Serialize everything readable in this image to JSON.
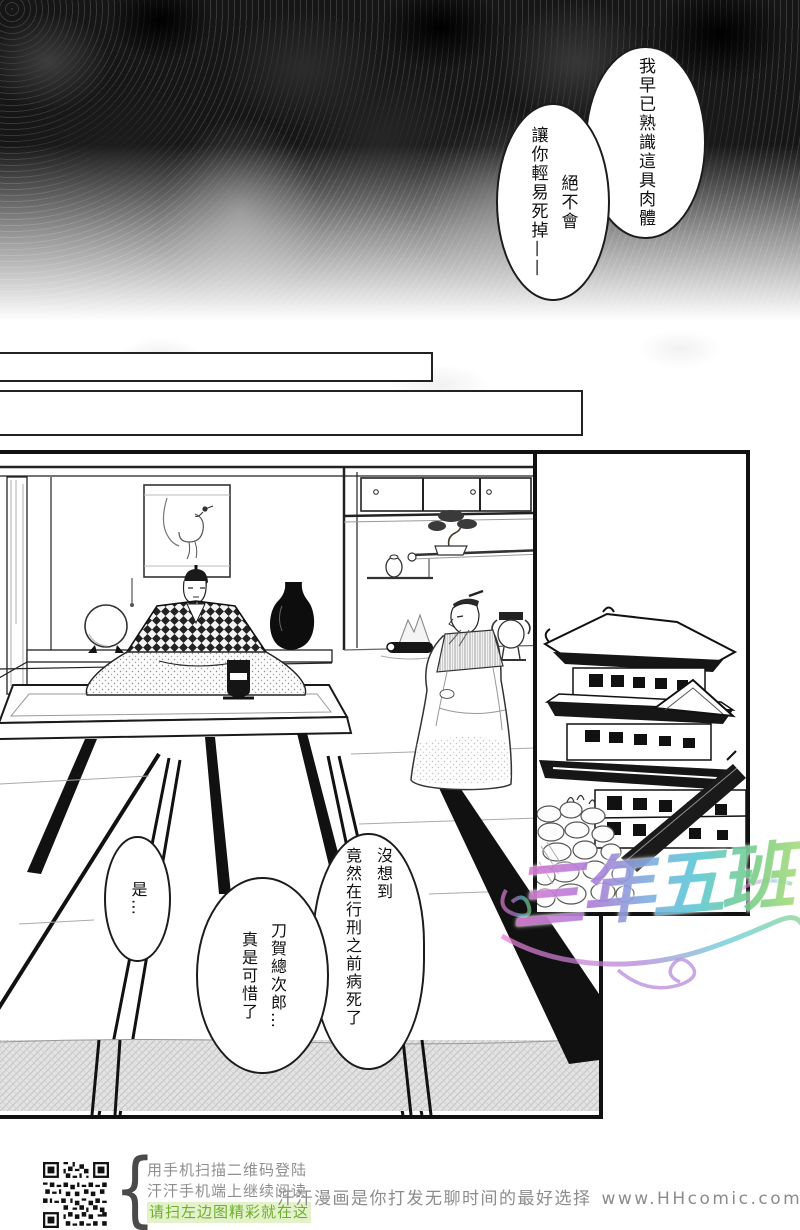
{
  "bubbles": {
    "known_body": {
      "lines": [
        "我早已熟識這具肉體"
      ]
    },
    "not_die": {
      "lines": [
        "絕不會",
        "讓你輕易死掉——"
      ]
    },
    "unexpected": {
      "lines": [
        "沒想到",
        "竟然在行刑之前病死了"
      ]
    },
    "pity": {
      "lines": [
        "刀賀總次郎…",
        "真是可惜了"
      ]
    },
    "yes": {
      "lines": [
        "是…"
      ]
    }
  },
  "watermark": {
    "text": "三年五班"
  },
  "footer": {
    "brace": "{",
    "qr_caption_lines": [
      "用手机扫描二维码登陆",
      "汗汗手机端上继续阅读",
      "请扫左边图精彩就在这"
    ],
    "tagline": "汗汗漫画是你打发无聊时间的最好选择",
    "url": "www.HHcomic.com"
  },
  "colors": {
    "caption_gray": "#8f8f8f",
    "caption_green": "#6fae2e",
    "caption_green_bg": "#e4f2cc",
    "ink": "#111111",
    "watermark_magenta": "#e77fd4",
    "watermark_purple": "#b07fd8",
    "watermark_cyan": "#5fc9d8",
    "watermark_green": "#7ed08a"
  }
}
